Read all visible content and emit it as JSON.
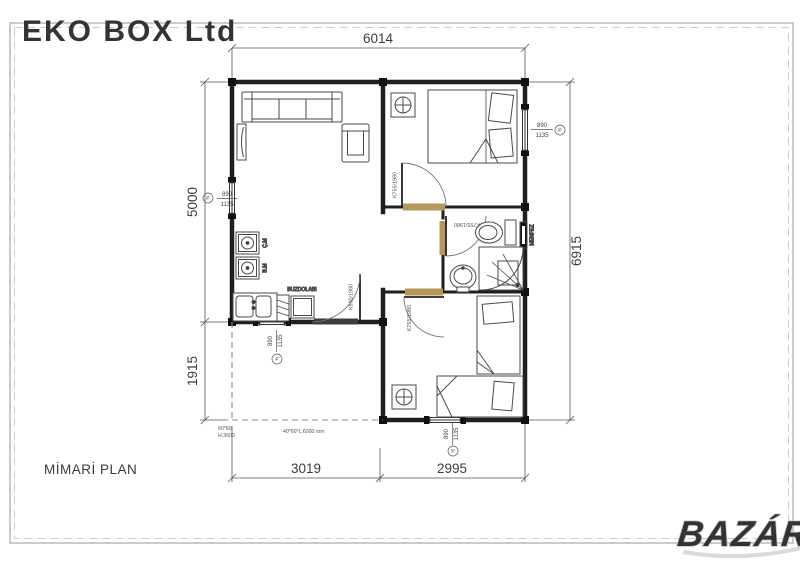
{
  "page": {
    "title": "MİMARİ PLAN",
    "watermark_top": "EKO BOX Ltd",
    "watermark_bottom": "BAZÁR"
  },
  "dimensions": {
    "top": "6014",
    "right": "6915",
    "left_upper": "5000",
    "left_lower": "1915",
    "bottom_left": "3019",
    "bottom_right": "2995"
  },
  "window": {
    "width": "890",
    "height": "1135",
    "symbol": "P"
  },
  "doors": {
    "entrance": "K890/1980",
    "interior": "K755/1980"
  },
  "kitchen": {
    "fridge": "BUZDOLABI",
    "washing_machine": "Ç.M",
    "dishwasher": "B.M"
  },
  "bathroom": {
    "vent": "MENFEZ"
  },
  "notes": {
    "column": "60*60",
    "column_height": "H:3600",
    "profile": "40*60*L:6000 mm"
  },
  "colors": {
    "wall": "#1f1f1f",
    "dimension": "#555555",
    "door_sill": "#b5985a",
    "watermark": "#ececec",
    "logo_outline": "#c6c6c6"
  }
}
